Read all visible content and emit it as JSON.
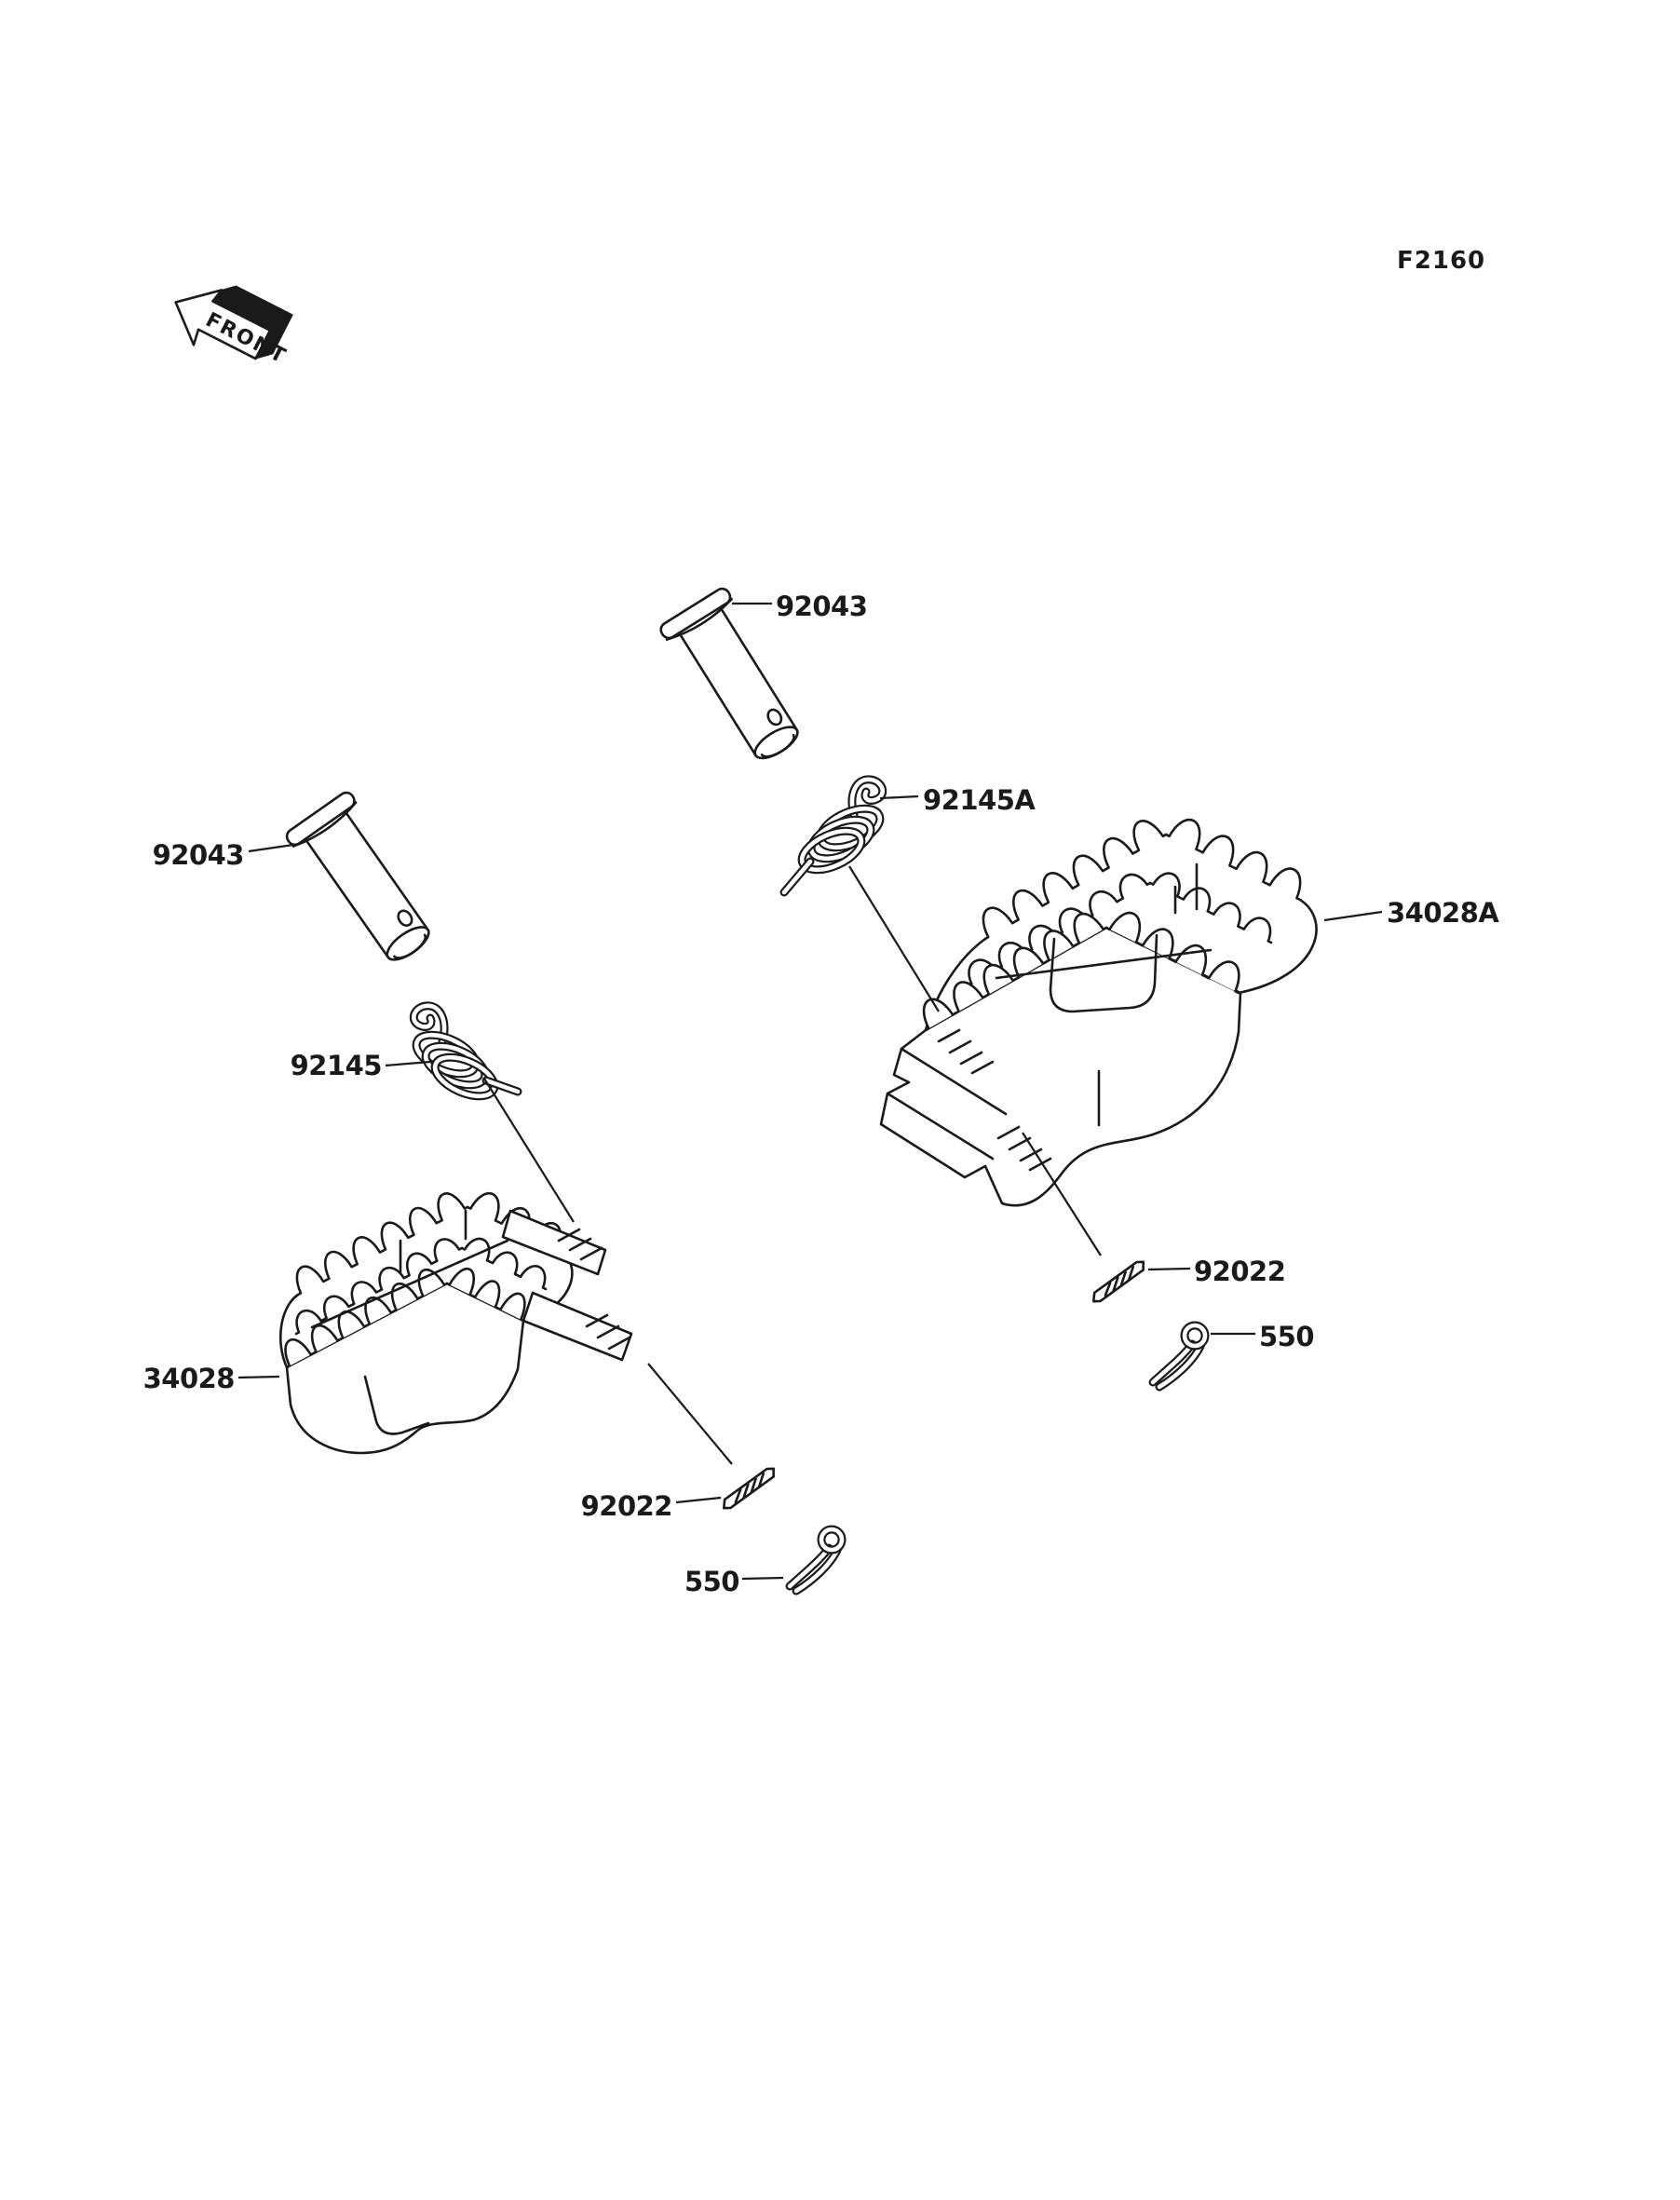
{
  "figure_code": "F2160",
  "front_marker": "FRONT",
  "labels": {
    "pin_upper": "92043",
    "pin_left": "92043",
    "spring_right": "92145A",
    "spring_left": "92145",
    "footpeg_right": "34028A",
    "footpeg_left": "34028",
    "dowel_right": "92022",
    "dowel_left": "92022",
    "cotter_right": "550",
    "cotter_left": "550"
  },
  "colors": {
    "line": "#1a1a1a",
    "background": "#ffffff"
  }
}
